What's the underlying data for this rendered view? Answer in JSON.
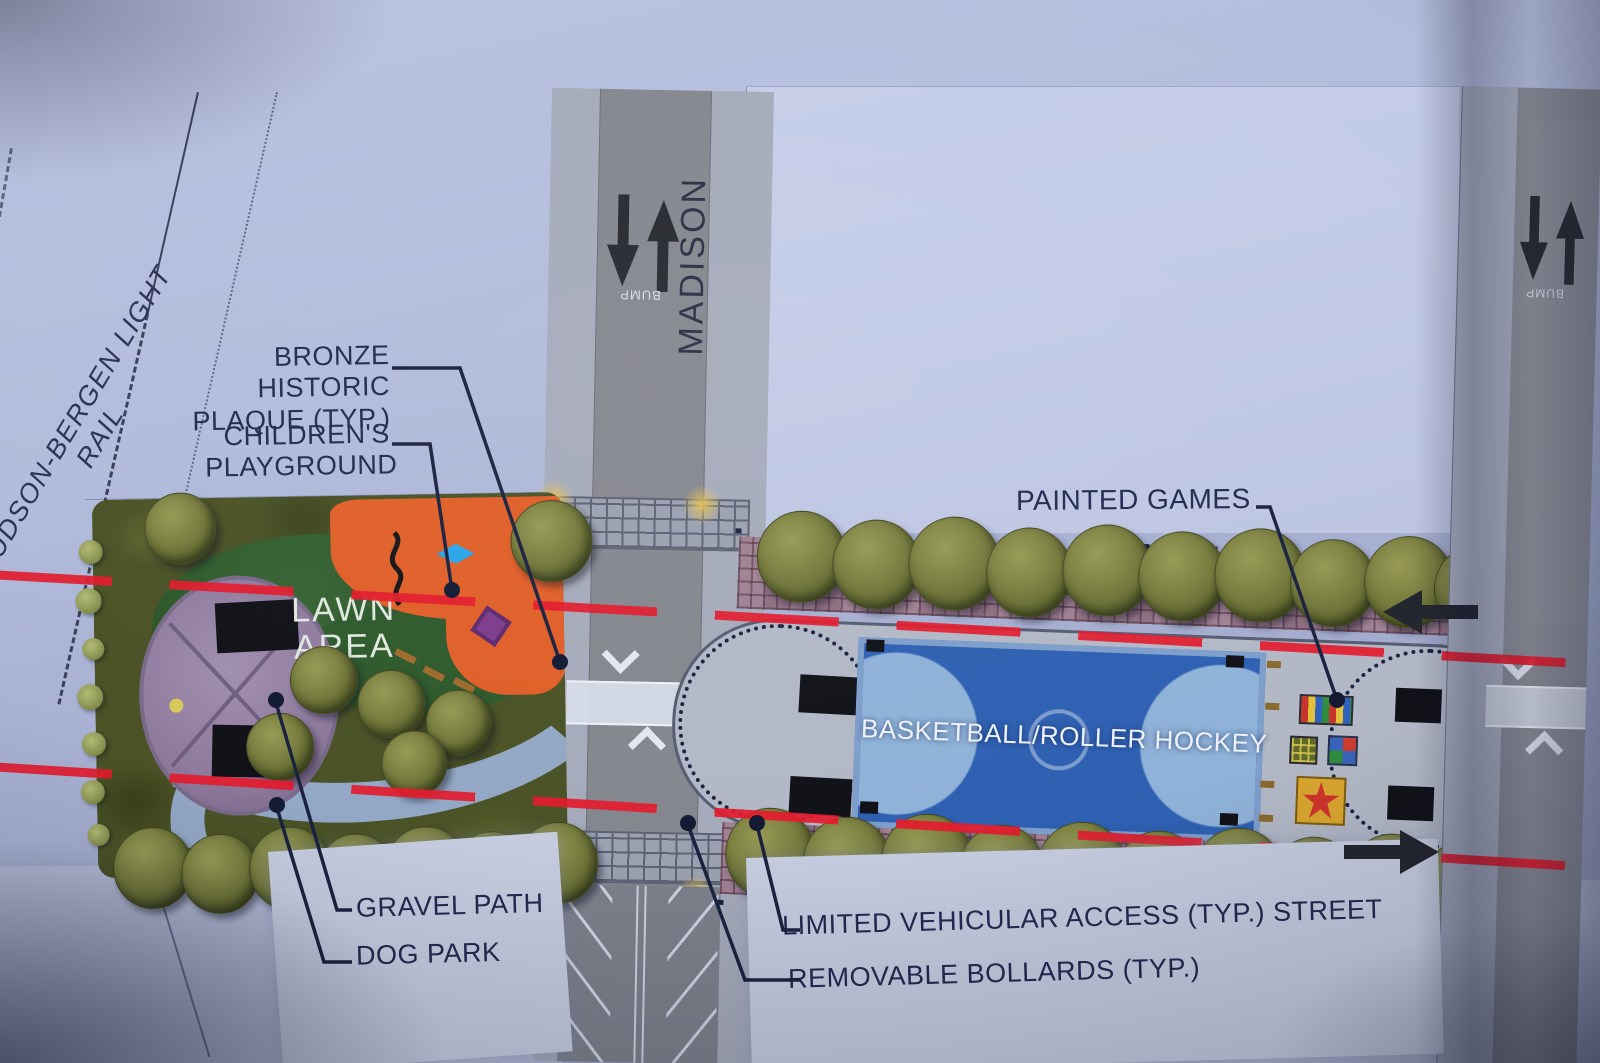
{
  "plan_labels": {
    "light_rail": "HUDSON-BERGEN LIGHT RAIL",
    "madison_street": "MADISON",
    "bump_marking": "BUMP",
    "lawn_area_line1": "LAWN",
    "lawn_area_line2": "AREA",
    "basketball_court": "BASKETBALL/ROLLER HOCKEY"
  },
  "callouts": {
    "bronze_plaque_line1": "BRONZE HISTORIC",
    "bronze_plaque_line2": "PLAQUE (TYP.)",
    "childrens_playground_line1": "CHILDREN'S",
    "childrens_playground_line2": "PLAYGROUND",
    "painted_games": "PAINTED GAMES",
    "gravel_path": "GRAVEL PATH",
    "dog_park": "DOG PARK",
    "limited_vehicular_access": "LIMITED VEHICULAR ACCESS (TYP.) STREET",
    "removable_bollards": "REMOVABLE BOLLARDS (TYP.)"
  },
  "colors": {
    "paper_blue": "#aeb7d8",
    "label_navy": "#212a50",
    "fire_lane_red": "#e31b2d",
    "court_blue": "#2e60b2",
    "court_key_blue": "#8fb2d8",
    "playground_orange": "#e05f28",
    "lawn_green": "#2e5a2c",
    "tree_olive": "#6d7336",
    "road_gray": "#85878f",
    "sidewalk_gray": "#a6abbb",
    "plaza_gray": "#b2b8c6",
    "brick_mauve": "#96798a"
  }
}
